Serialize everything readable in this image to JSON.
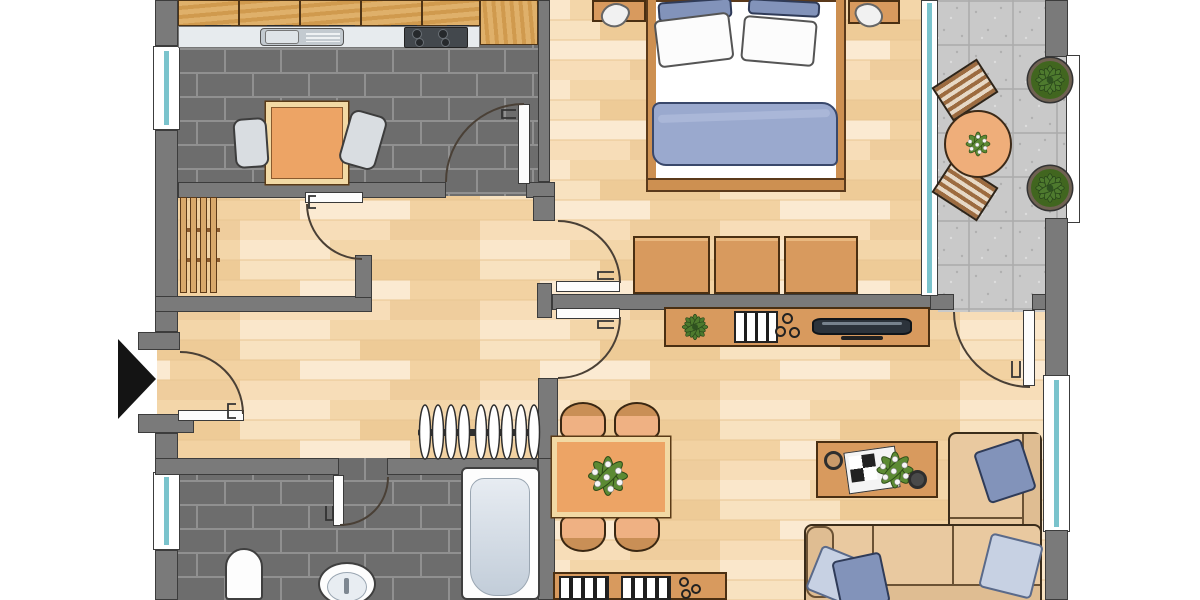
{
  "colors": {
    "wall": "#7a7a7a",
    "wall_line": "#3c3c3c",
    "tile_floor": "#6d6d6d",
    "tile_grout": "#909090",
    "wood_light": "#f6dcb4",
    "cabinet_wood": "#d39c52",
    "furniture_wood": "#d89a5e",
    "table_orange": "#eda465",
    "table_frame": "#f2d9a4",
    "counter": "#e7ebee",
    "steel": "#c3cad0",
    "stove": "#43484d",
    "glass_teal": "#7ac3cc",
    "balcony_tile": "#c9c9c9",
    "balcony_line": "#ababab",
    "plant_green": "#4e7a2e",
    "plant_green_light": "#679540",
    "sofa": "#e9c9a0",
    "sofa_dark": "#dfbd92",
    "pillow_blue": "#8293ba",
    "pillow_light": "#c7d1e3",
    "blanket": "#9aa9ce",
    "chair_gray": "#d9dde1",
    "white": "#fdfdfd",
    "arc": "#4a4036",
    "black": "#141414"
  },
  "floor_plan": {
    "type": "apartment-top-view",
    "entrance_marker": "black-arrow-pointing-right",
    "rooms": [
      {
        "name": "kitchen",
        "floor": "dark-gray-brick-tile",
        "furniture": [
          "cabinet-row-5-units",
          "countertop",
          "sink-with-drainer",
          "stove-4-burners",
          "tall-cabinet",
          "square-table",
          "chair-left",
          "chair-right"
        ],
        "windows": 1,
        "doors": [
          "to-hallway"
        ]
      },
      {
        "name": "storage-room",
        "floor": "wood-parquet",
        "furniture": [
          "slatted-rack-4-boards"
        ],
        "doors": [
          "to-hallway"
        ]
      },
      {
        "name": "hallway",
        "floor": "wood-parquet",
        "furniture": [
          "coat-rack-with-9-hangers"
        ],
        "doors": [
          "entrance-door",
          "to-kitchen",
          "to-storage-room",
          "to-bedroom",
          "to-living-room",
          "to-bathroom"
        ]
      },
      {
        "name": "bedroom",
        "floor": "wood-parquet",
        "furniture": [
          "double-bed",
          "pillow-blue-left",
          "pillow-blue-right",
          "pillow-white-left",
          "pillow-white-right",
          "blanket",
          "nightstand-left-with-lamp",
          "nightstand-right-with-lamp",
          "wardrobe-3-sections"
        ],
        "windows": [
          "glass-front-to-balcony"
        ]
      },
      {
        "name": "balcony",
        "floor": "gray-tile",
        "furniture": [
          "round-table",
          "plant-on-table",
          "slatted-chair-top",
          "slatted-chair-bottom",
          "potted-plant-top",
          "potted-plant-bottom"
        ],
        "features": [
          "railing-with-bay"
        ]
      },
      {
        "name": "living-room",
        "floor": "wood-parquet",
        "furniture": [
          "tv-sideboard",
          "plant-on-sideboard",
          "binders-on-sideboard",
          "three-bowls",
          "flat-tv",
          "dining-table",
          "plant-centerpiece",
          "dining-chair-top-left",
          "dining-chair-top-right",
          "dining-chair-bottom-left",
          "dining-chair-bottom-right",
          "coffee-table",
          "cup-left",
          "magazine",
          "plant-on-coffee-table",
          "cup-right",
          "corner-sofa-right",
          "corner-sofa-bottom",
          "cushion-1",
          "cushion-2",
          "cushion-3",
          "cushion-4",
          "lowboard-with-binders-and-bowls"
        ],
        "windows": 1,
        "doors": [
          "to-hallway",
          "to-balcony"
        ]
      },
      {
        "name": "bathroom",
        "floor": "dark-gray-brick-tile",
        "furniture": [
          "bathtub",
          "toilet",
          "washbasin-with-faucet"
        ],
        "windows": 1,
        "doors": [
          "to-hallway"
        ]
      }
    ]
  }
}
